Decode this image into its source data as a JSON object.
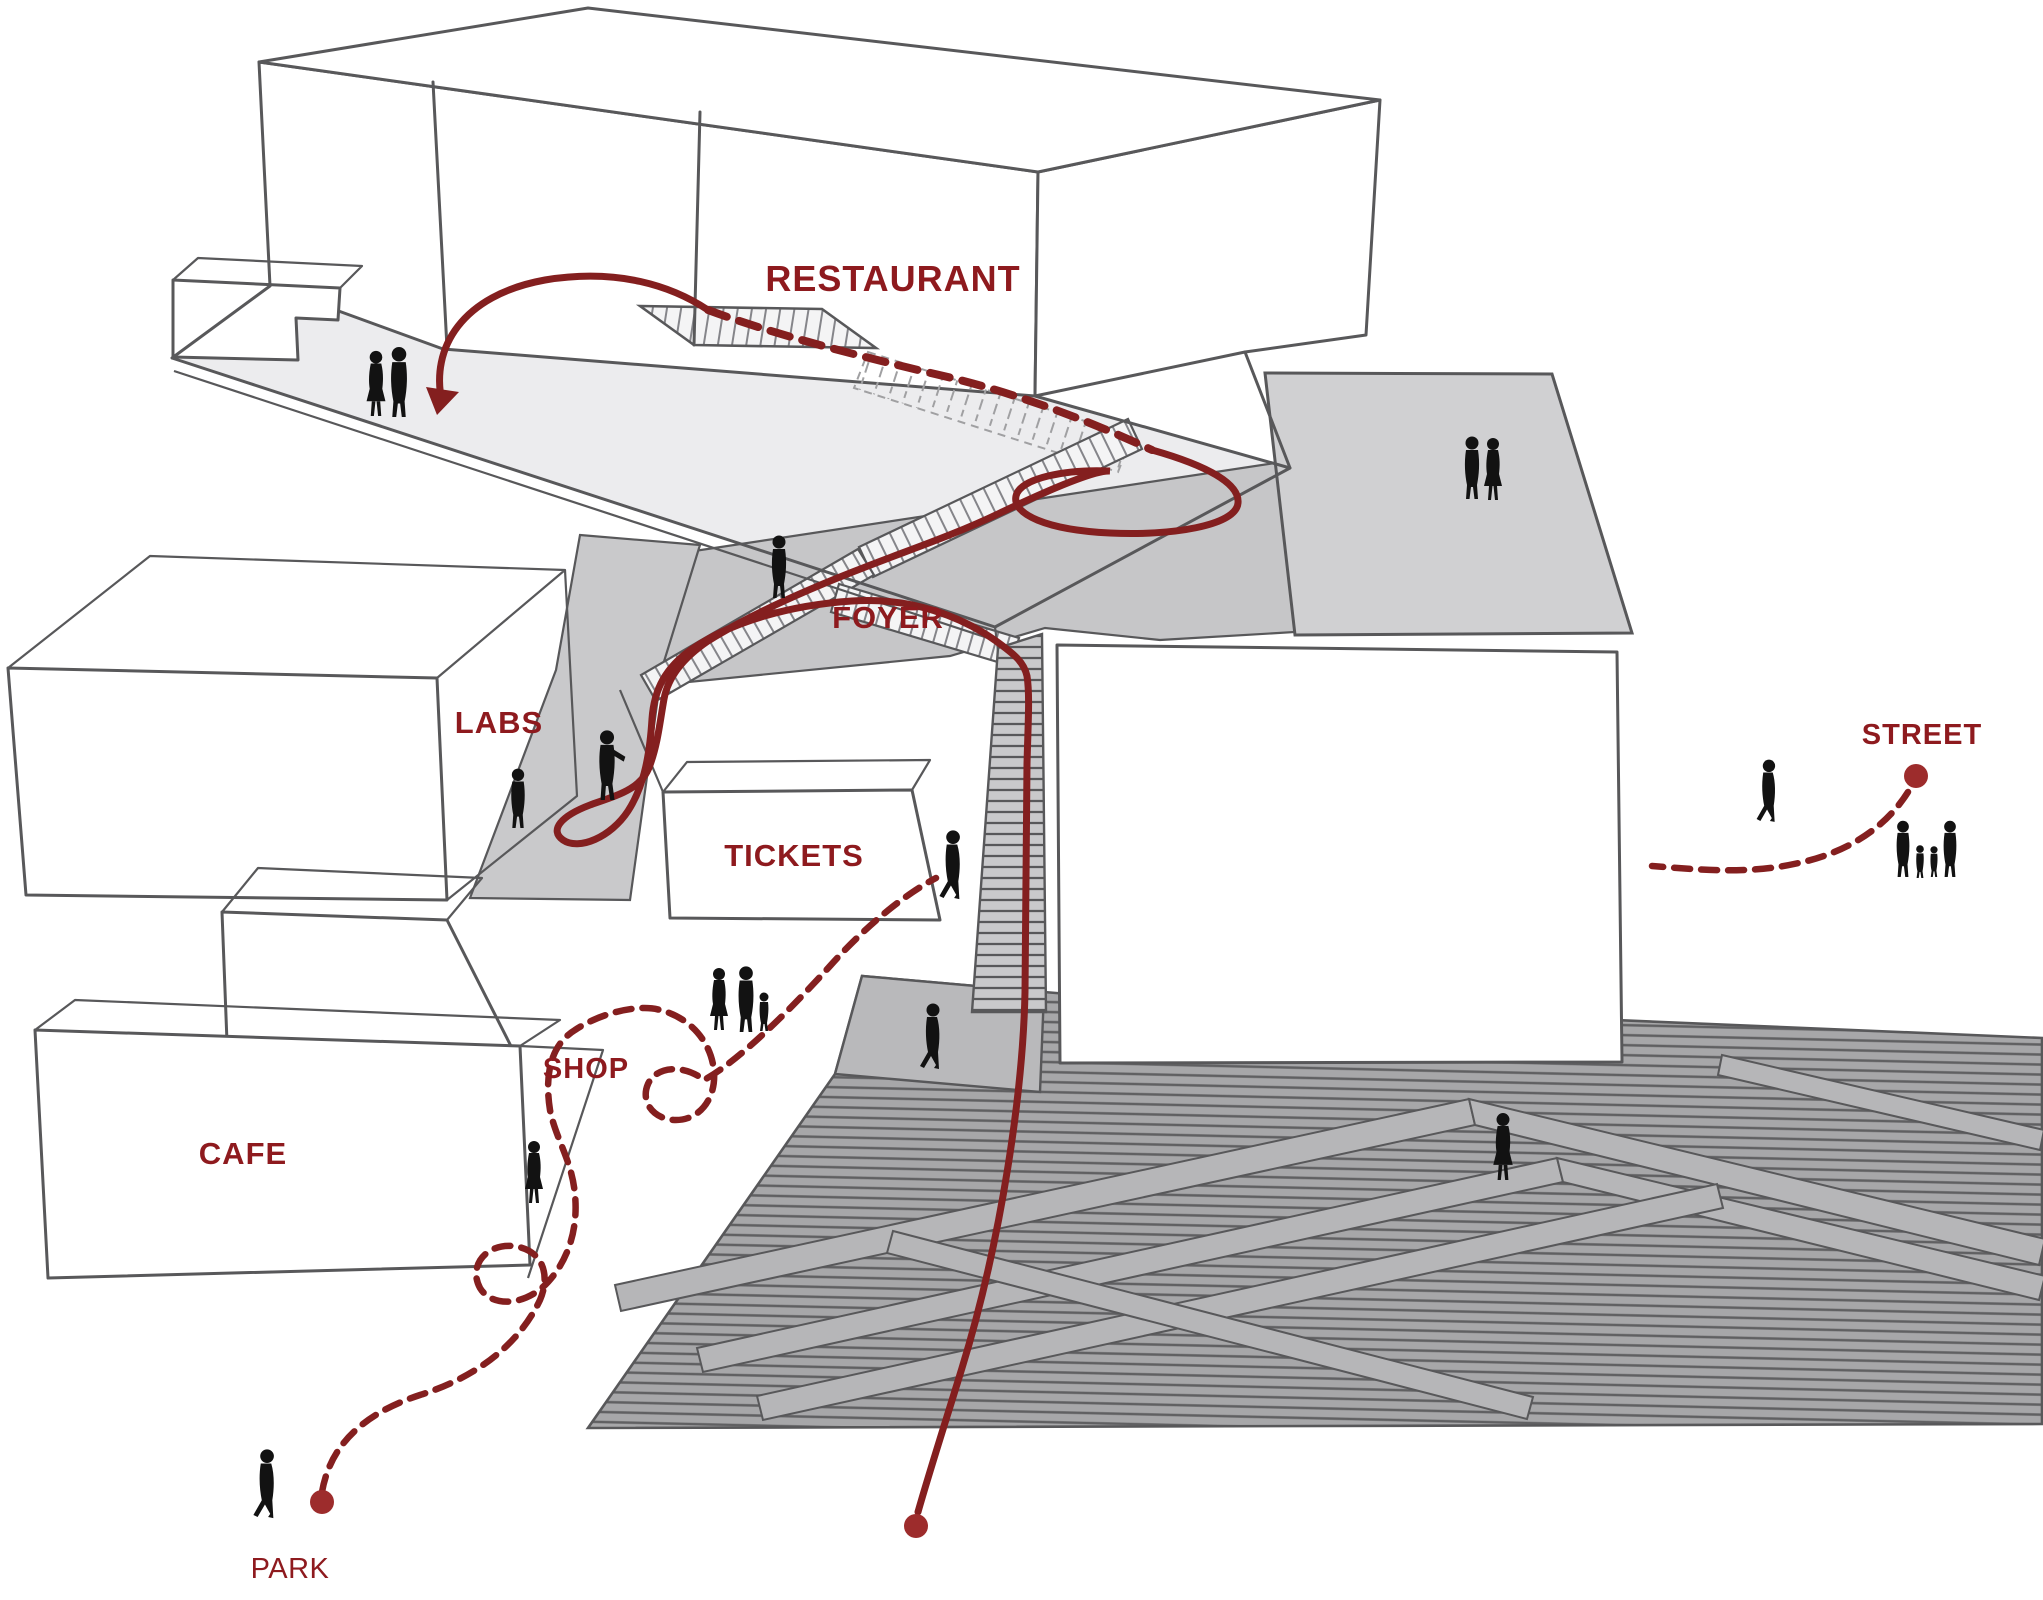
{
  "labels": {
    "restaurant": "RESTAURANT",
    "foyer": "FOYER",
    "labs": "LABS",
    "tickets": "TICKETS",
    "shop": "SHOP",
    "cafe": "CAFE",
    "street": "STREET",
    "park": "PARK"
  },
  "colors": {
    "background": "#ffffff",
    "outline": "#58585a",
    "deck_grey": "#ececee",
    "roof_grey": "#d0d0d2",
    "floor_grey": "#c6c6c8",
    "ramp_grey": "#c9c9cb",
    "stair_light": "#f4f4f5",
    "plaza_grey": "#a7a7a9",
    "plaza_line": "#606062",
    "landing_grey": "#b9b9bb",
    "ramp_bar": "#b6b6b8",
    "path_red": "#841f1f",
    "label_red": "#8e1a1e",
    "dot_red": "#9d2c2c",
    "figure_black": "#121212",
    "ghost_line": "#a0a0a2"
  },
  "figures": [
    "couple-on-roof-terrace",
    "couple-on-right-roof",
    "person-in-foyer",
    "person-pointing-labs",
    "person-standing-labs",
    "man-walking-to-stair",
    "family-of-three",
    "person-on-landing",
    "woman-near-shop",
    "man-walking-park",
    "person-walking-street",
    "family-of-four-street",
    "woman-on-plaza"
  ]
}
